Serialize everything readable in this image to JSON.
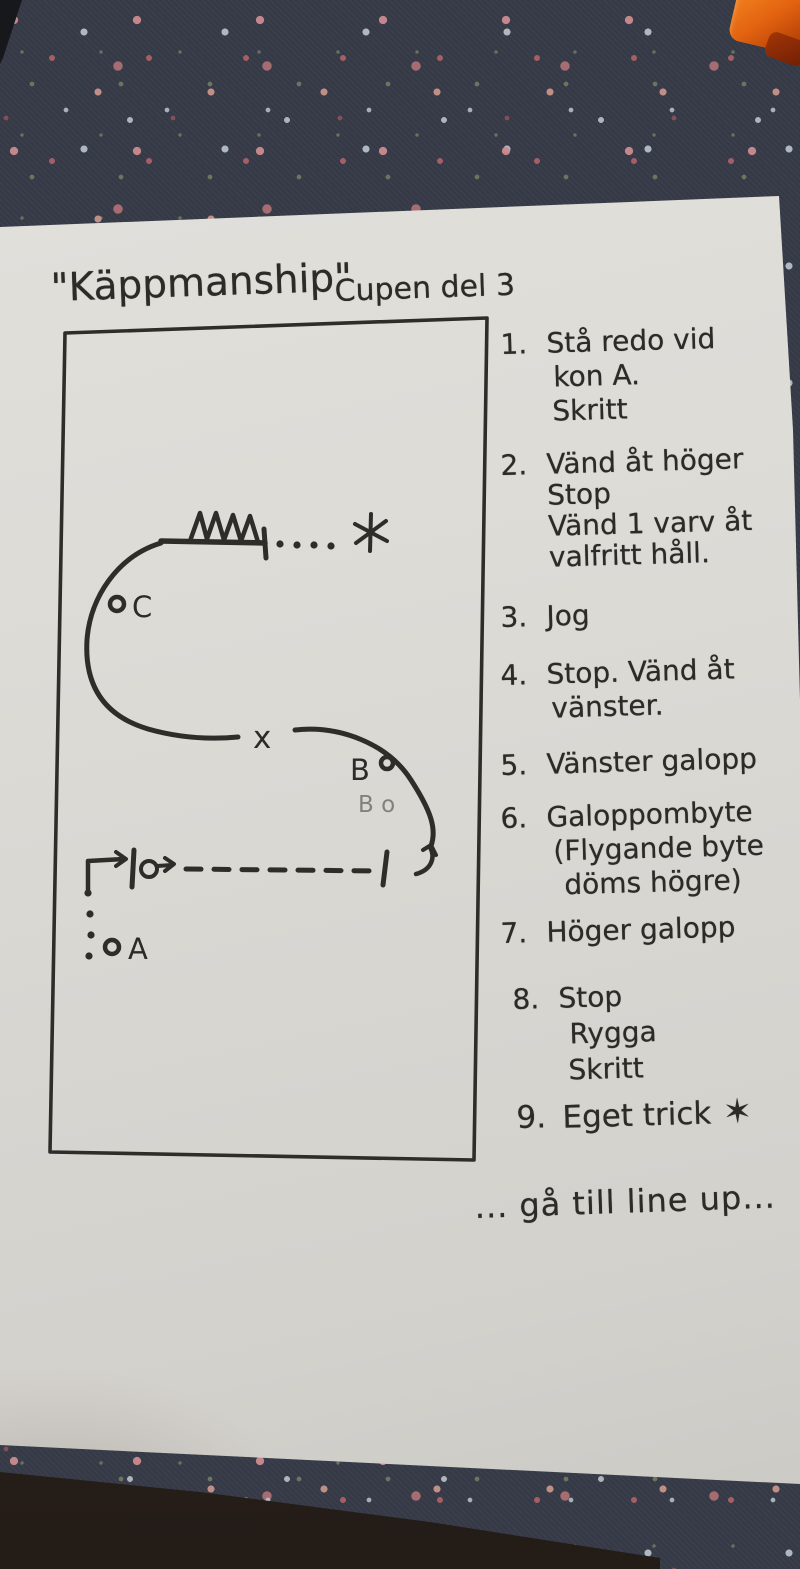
{
  "title": {
    "main": "\"Käppmanship\"",
    "sub": "Cupen del 3"
  },
  "diagram": {
    "cone_c": "C",
    "cone_b": "B",
    "cone_a": "A",
    "crossover": "x",
    "pencil_note": "B o"
  },
  "instructions": {
    "items": [
      {
        "num": "1.",
        "lines": [
          "Stå redo vid",
          "kon A.",
          "Skritt"
        ]
      },
      {
        "num": "2.",
        "lines": [
          "Vänd åt höger",
          "Stop",
          "Vänd 1 varv åt",
          "valfritt håll."
        ]
      },
      {
        "num": "3.",
        "lines": [
          "Jog"
        ]
      },
      {
        "num": "4.",
        "lines": [
          "Stop. Vänd åt",
          "vänster."
        ]
      },
      {
        "num": "5.",
        "lines": [
          "Vänster galopp"
        ]
      },
      {
        "num": "6.",
        "lines": [
          "Galoppombyte",
          "(Flygande byte",
          "döms högre)"
        ]
      },
      {
        "num": "7.",
        "lines": [
          "Höger galopp"
        ]
      },
      {
        "num": "8.",
        "lines": [
          "Stop",
          "Rygga",
          "Skritt"
        ]
      },
      {
        "num": "9.",
        "lines": [
          "Eget trick"
        ],
        "star": "✶"
      }
    ],
    "footer": "... gå till line up..."
  },
  "colors": {
    "fabric": "#363a47",
    "paper": "#dbd9d4",
    "ink": "#2d2b27",
    "orange": "#d95f12"
  }
}
